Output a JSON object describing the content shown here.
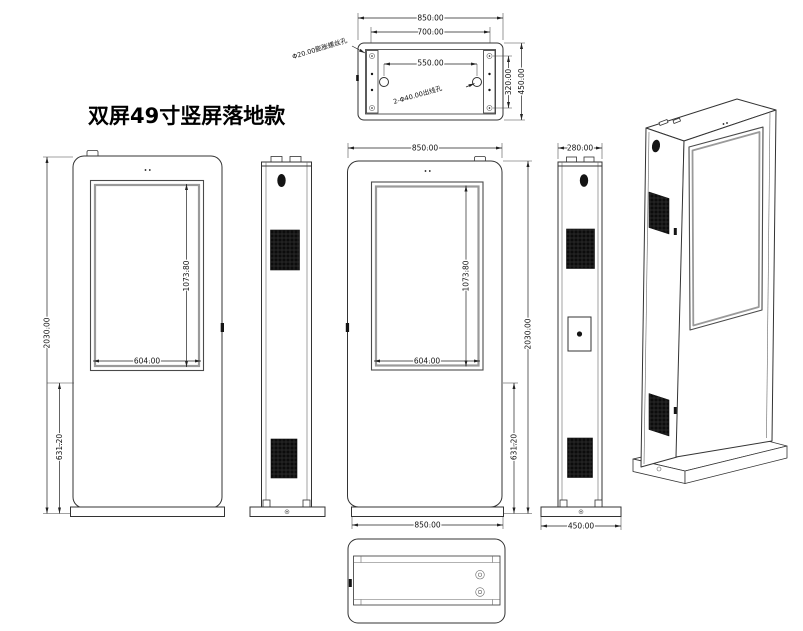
{
  "title": "双屏49寸竖屏落地款",
  "drawing": {
    "top_view": {
      "dim_outer_width": "850.00",
      "dim_inner_width": "700.00",
      "dim_hole_spacing": "550.00",
      "dim_inner_height": "320.00",
      "dim_outer_height": "450.00",
      "callout_anchor_hole": "Φ20.00膨胀螺丝孔",
      "callout_cable_hole": "2-Φ40.00出线孔"
    },
    "front_view": {
      "dim_total_height": "2030.00",
      "dim_screen_height": "1073.80",
      "dim_screen_width": "604.00",
      "dim_lower_height": "631.20"
    },
    "rear_view": {
      "dim_width_top": "850.00",
      "dim_screen_height": "1073.80",
      "dim_screen_width": "604.00",
      "dim_total_height": "2030.00",
      "dim_lower_height": "631.20",
      "dim_width_bottom": "850.00"
    },
    "side_view_right": {
      "dim_depth": "280.00",
      "dim_base_depth": "450.00"
    },
    "line_color": "#333333",
    "vent_color": "#141414"
  }
}
